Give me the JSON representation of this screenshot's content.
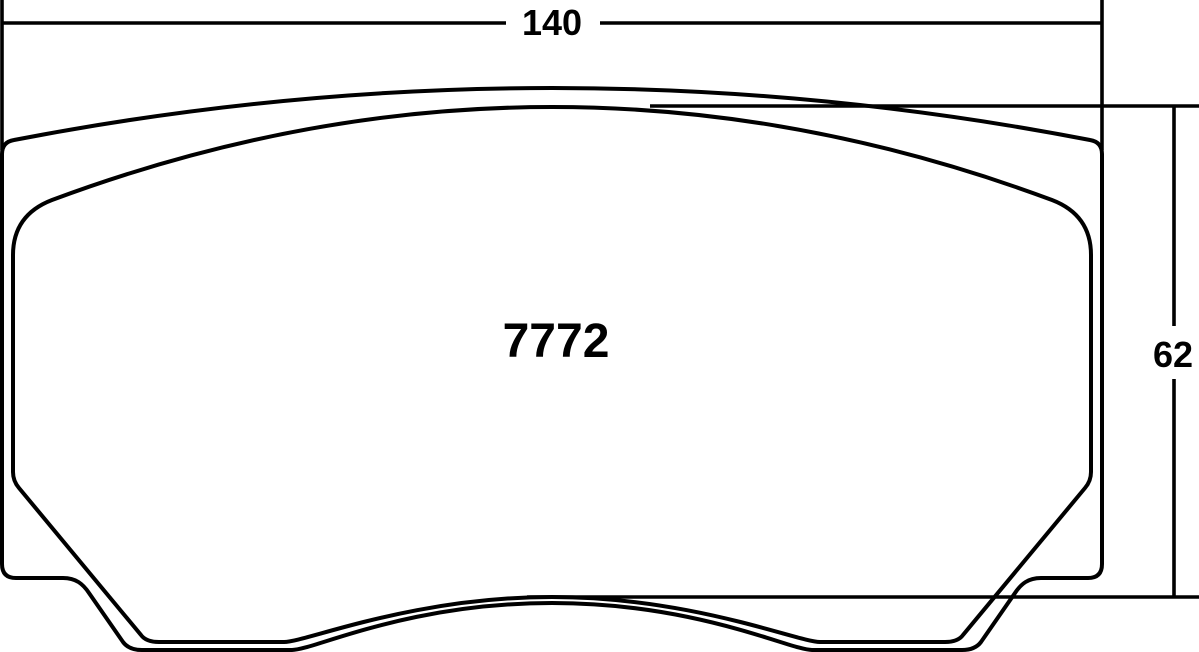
{
  "diagram": {
    "part_number": "7772",
    "dimensions": {
      "width_label": "140",
      "height_label": "62"
    },
    "colors": {
      "line": "#000000",
      "friction_fill": "#dcddde",
      "background": "#ffffff"
    }
  }
}
